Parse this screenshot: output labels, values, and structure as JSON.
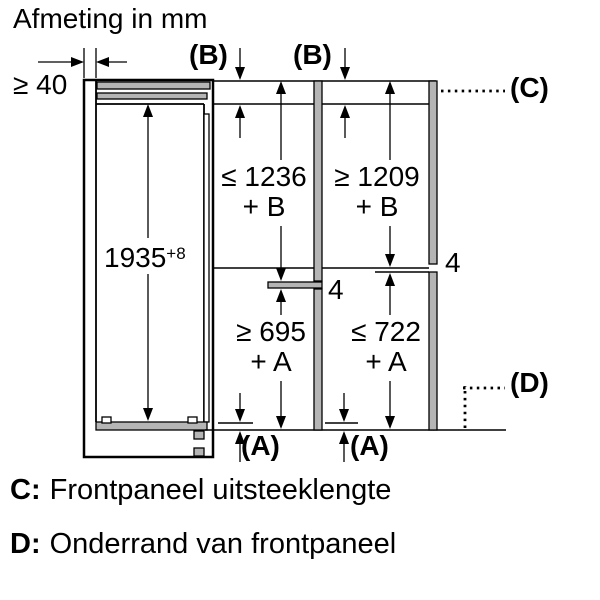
{
  "title": "Afmeting in mm",
  "labels": {
    "wall_gap": "≥ 40",
    "b_marker_1": "(B)",
    "b_marker_2": "(B)",
    "c_marker": "(C)",
    "d_marker": "(D)",
    "a_marker_1": "(A)",
    "a_marker_2": "(A)",
    "niche_height_value": "1935",
    "niche_height_tolerance": "+8",
    "upper_left_dim_line1": "≤ 1236",
    "upper_left_dim_line2": "+ B",
    "upper_right_dim_line1": "≥ 1209",
    "upper_right_dim_line2": "+ B",
    "lower_left_dim_line1": "≥ 695",
    "lower_left_dim_line2": "+ A",
    "lower_right_dim_line1": "≤ 722",
    "lower_right_dim_line2": "+ A",
    "divider_thickness_left": "4",
    "divider_thickness_right": "4"
  },
  "legend": [
    {
      "key": "C:",
      "text": "Frontpaneel uitsteeklengte"
    },
    {
      "key": "D:",
      "text": "Onderrand van frontpaneel"
    }
  ],
  "colors": {
    "line": "#000000",
    "panel_gray": "#b5b5b5",
    "background": "#ffffff"
  }
}
